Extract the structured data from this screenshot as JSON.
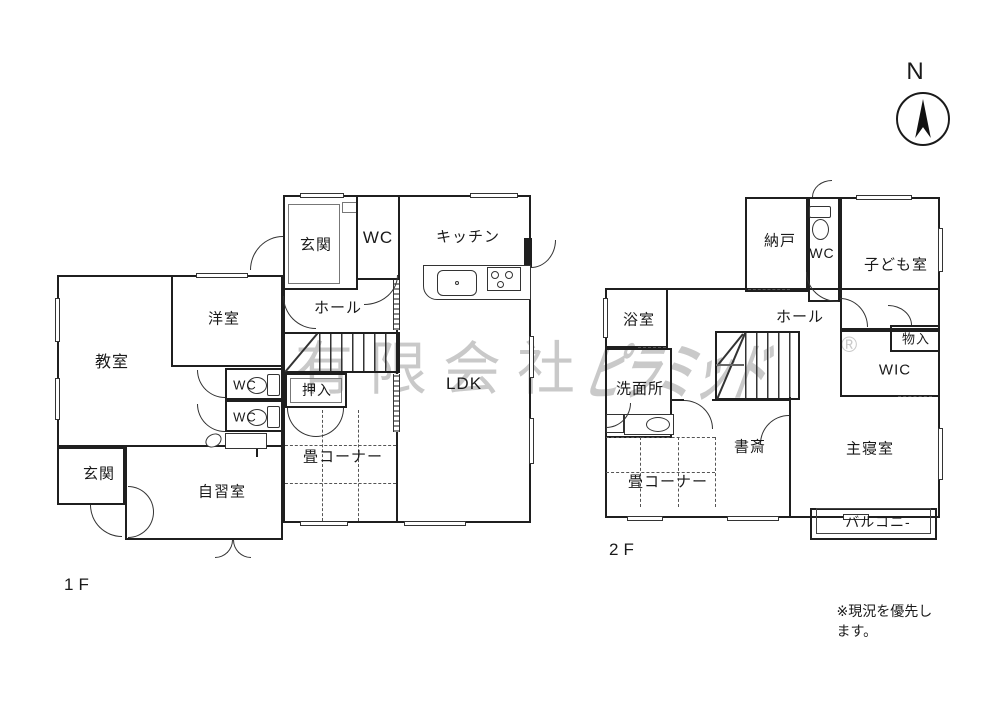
{
  "compass": {
    "label": "N"
  },
  "watermark": {
    "prefix": "有限会社",
    "name": "ピラミッド",
    "mark": "®"
  },
  "note": "※現況を優先します。",
  "floor1": {
    "label": "1F",
    "rooms": {
      "genkan_upper": "玄関",
      "wc_upper": "WC",
      "kitchen": "キッチン",
      "hall": "ホール",
      "youshitsu": "洋室",
      "kyoushitsu": "教室",
      "wc_1": "WC",
      "wc_2": "WC",
      "oshiire": "押入",
      "tatami_corner": "畳コーナー",
      "ldk": "LDK",
      "genkan_lower": "玄関",
      "jishuushitsu": "自習室"
    }
  },
  "floor2": {
    "label": "2F",
    "rooms": {
      "nando": "納戸",
      "wc": "WC",
      "kodomoshitsu": "子ども室",
      "hall": "ホール",
      "yokushitsu": "浴室",
      "senmenjo": "洗面所",
      "monoire": "物入",
      "wic": "WIC",
      "shosai": "書斎",
      "shushinshitsu": "主寝室",
      "tatami_corner": "畳コーナー",
      "balcony": "バルコニ-"
    }
  }
}
